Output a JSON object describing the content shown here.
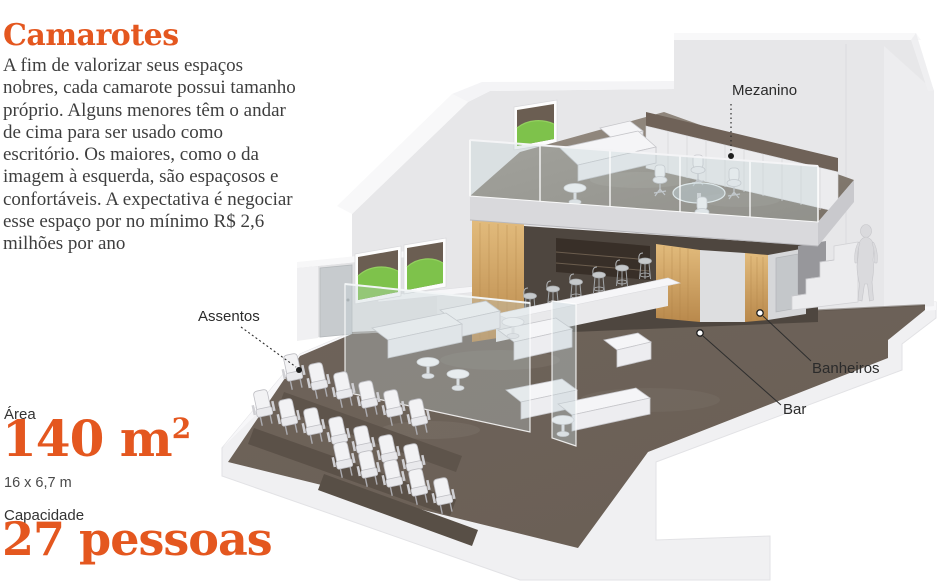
{
  "page": {
    "title": "Camarotes",
    "description": "A fim de valorizar seus espaços nobres, cada camarote possui tamanho próprio. Alguns menores têm o andar de cima para ser usado como escritório. Os maiores, como o da imagem à esquerda, são espaçosos e confortáveis. A expectativa é negociar esse espaço por no mínimo R$ 2,6 milhões por ano"
  },
  "stats": {
    "area_label": "Área",
    "area_value": "140",
    "area_unit": " m",
    "area_sup": "2",
    "area_dimensions": "16 x 6,7 m",
    "capacity_label": "Capacidade",
    "capacity_value": "27",
    "capacity_unit": " pessoas"
  },
  "callouts": {
    "mezzanine": "Mezanino",
    "seats": "Assentos",
    "bathrooms": "Banheiros",
    "bar": "Bar"
  },
  "colors": {
    "accent": "#E4571F",
    "body_text": "#3E3E3E",
    "floor_taupe": "#6C6157",
    "wood": "#D2A364",
    "field_green": "#7EC24B",
    "wall_gray": "#E7E7E9"
  },
  "illustration": {
    "scene": "isometric cutaway of a stadium luxury box",
    "seat_rows": [
      6,
      7,
      5
    ],
    "features": [
      "Mezanino",
      "Assentos",
      "Banheiros",
      "Bar"
    ]
  }
}
